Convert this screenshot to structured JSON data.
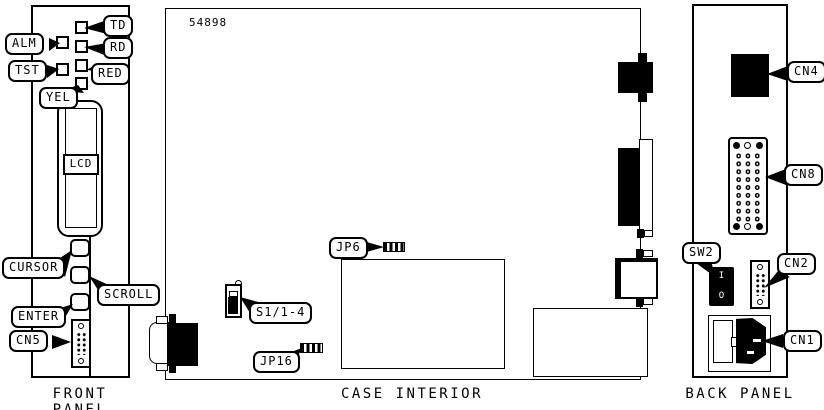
{
  "figure_number": "54898",
  "front_panel": {
    "caption": "FRONT PANEL",
    "led_labels": {
      "alm": "ALM",
      "tst": "TST",
      "td": "TD",
      "rd": "RD",
      "red": "RED",
      "yel": "YEL"
    },
    "lcd_label": "LCD",
    "button_labels": {
      "cursor": "CURSOR",
      "scroll": "SCROLL",
      "enter": "ENTER"
    },
    "connector_labels": {
      "cn5": "CN5"
    }
  },
  "case_interior": {
    "caption": "CASE INTERIOR",
    "component_labels": {
      "jp6": "JP6",
      "s1": "S1/1-4",
      "jp16": "JP16"
    }
  },
  "back_panel": {
    "caption": "BACK PANEL",
    "component_labels": {
      "cn4": "CN4",
      "cn8": "CN8",
      "sw2": "SW2",
      "cn2": "CN2",
      "cn1": "CN1"
    },
    "power_switch_markings": {
      "on": "I",
      "off": "O"
    }
  },
  "colors": {
    "ink": "#000000",
    "paper": "#ffffff"
  }
}
